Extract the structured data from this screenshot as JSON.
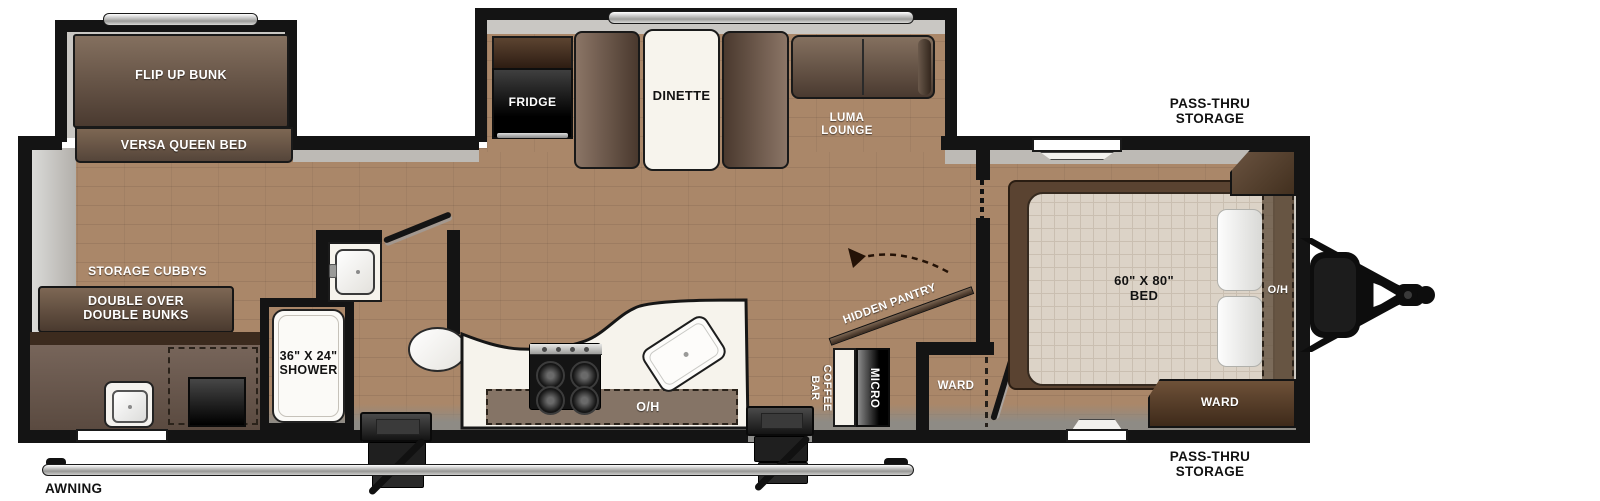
{
  "floorplan": {
    "front_bunk_room": {
      "flip_up_bunk": "FLIP UP BUNK",
      "versa_queen_bed": "VERSA QUEEN BED",
      "storage_cubbys": "STORAGE CUBBYS",
      "bunks_line1": "DOUBLE OVER",
      "bunks_line2": "DOUBLE BUNKS"
    },
    "bathroom": {
      "shower_size": "36\" X 24\"",
      "shower": "SHOWER"
    },
    "kitchen": {
      "fridge": "FRIDGE",
      "dinette": "DINETTE",
      "overhead": "O/H",
      "hidden_pantry": "HIDDEN PANTRY",
      "coffee_line1": "COFFEE",
      "coffee_line2": "BAR",
      "micro": "MICRO"
    },
    "living": {
      "luma_line1": "LUMA",
      "luma_line2": "LOUNGE"
    },
    "mid_ward": "WARD",
    "bedroom": {
      "bed_size": "60\" X 80\"",
      "bed": "BED",
      "ward": "WARD",
      "overhead": "O/H"
    },
    "exterior": {
      "pass_thru_line1": "PASS-THRU",
      "pass_thru_line2": "STORAGE",
      "awning": "AWNING"
    },
    "colors": {
      "wall": "#141414",
      "floor": "#aa8769",
      "furniture_brown": "#5d4936",
      "counter_white": "#f6f3ec",
      "appliance_black": "#111111",
      "shade_gray": "#bdbab5"
    }
  }
}
